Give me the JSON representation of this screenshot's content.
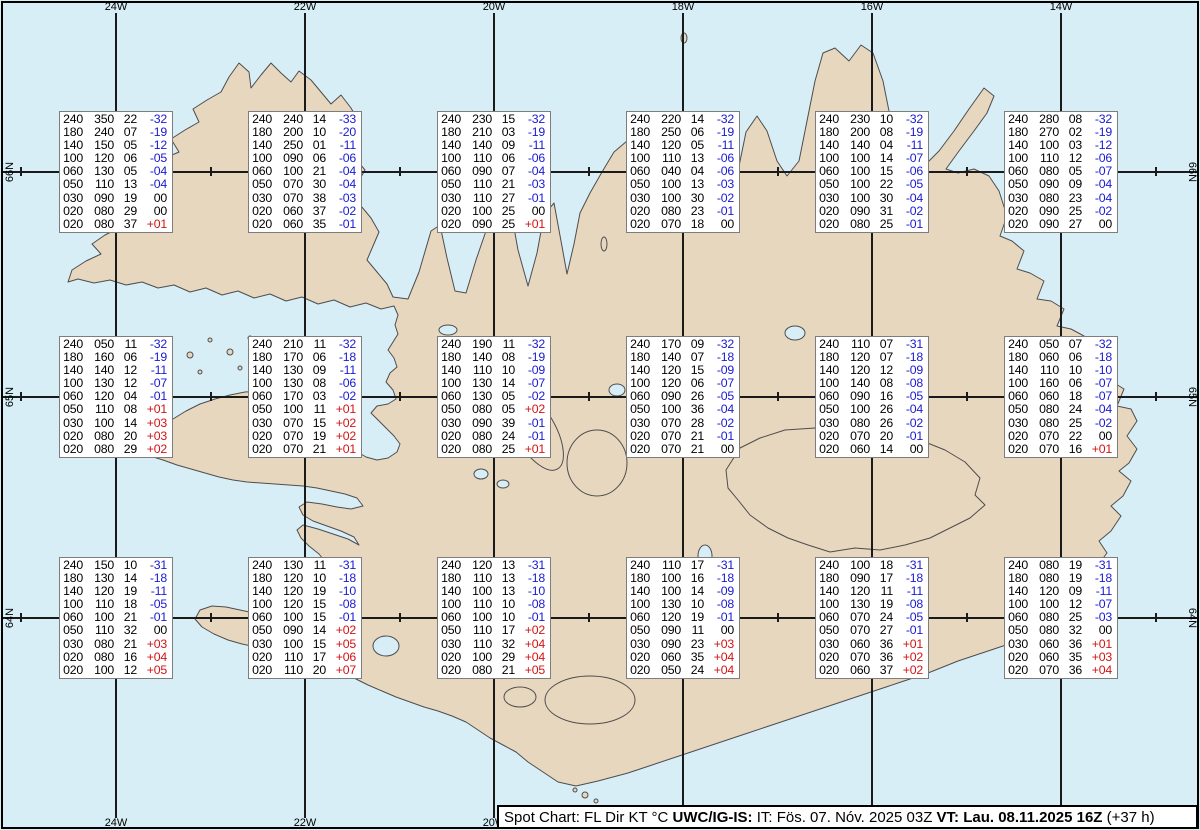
{
  "colors": {
    "ocean": "#d8eef7",
    "land": "#e8d7bf",
    "coast": "#4d4d4d",
    "grid": "#1a1a1a",
    "temp_negative": "#1a1ad2",
    "temp_positive": "#d21414",
    "temp_zero": "#000000",
    "box_border": "#7d7d7d"
  },
  "grid": {
    "meridians": [
      {
        "label": "24W",
        "x": 116
      },
      {
        "label": "22W",
        "x": 305
      },
      {
        "label": "20W",
        "x": 494
      },
      {
        "label": "18W",
        "x": 683
      },
      {
        "label": "16W",
        "x": 872
      },
      {
        "label": "14W",
        "x": 1061
      }
    ],
    "parallels": [
      {
        "label": "66N",
        "y": 172
      },
      {
        "label": "65N",
        "y": 397
      },
      {
        "label": "64N",
        "y": 618
      }
    ],
    "minor_tick_xs": [
      21,
      211,
      400,
      589,
      778,
      967,
      1156
    ]
  },
  "stations": [
    {
      "id": "66N-24W",
      "col": 0,
      "row": 0,
      "levels": [
        [
          "240",
          "350",
          "22",
          "-32"
        ],
        [
          "180",
          "240",
          "07",
          "-19"
        ],
        [
          "140",
          "150",
          "05",
          "-12"
        ],
        [
          "100",
          "120",
          "06",
          "-05"
        ],
        [
          "060",
          "130",
          "05",
          "-04"
        ],
        [
          "050",
          "110",
          "13",
          "-04"
        ],
        [
          "030",
          "090",
          "19",
          "00"
        ],
        [
          "020",
          "080",
          "29",
          "00"
        ],
        [
          "020",
          "080",
          "37",
          "+01"
        ]
      ]
    },
    {
      "id": "66N-22W",
      "col": 1,
      "row": 0,
      "levels": [
        [
          "240",
          "240",
          "14",
          "-33"
        ],
        [
          "180",
          "200",
          "10",
          "-20"
        ],
        [
          "140",
          "250",
          "01",
          "-11"
        ],
        [
          "100",
          "090",
          "06",
          "-06"
        ],
        [
          "060",
          "100",
          "21",
          "-04"
        ],
        [
          "050",
          "070",
          "30",
          "-04"
        ],
        [
          "030",
          "070",
          "38",
          "-03"
        ],
        [
          "020",
          "060",
          "37",
          "-02"
        ],
        [
          "020",
          "060",
          "35",
          "-01"
        ]
      ]
    },
    {
      "id": "66N-20W",
      "col": 2,
      "row": 0,
      "levels": [
        [
          "240",
          "230",
          "15",
          "-32"
        ],
        [
          "180",
          "210",
          "03",
          "-19"
        ],
        [
          "140",
          "140",
          "09",
          "-11"
        ],
        [
          "100",
          "110",
          "06",
          "-06"
        ],
        [
          "060",
          "090",
          "07",
          "-04"
        ],
        [
          "050",
          "110",
          "21",
          "-03"
        ],
        [
          "030",
          "110",
          "27",
          "-01"
        ],
        [
          "020",
          "100",
          "25",
          "00"
        ],
        [
          "020",
          "090",
          "25",
          "+01"
        ]
      ]
    },
    {
      "id": "66N-18W",
      "col": 3,
      "row": 0,
      "levels": [
        [
          "240",
          "220",
          "14",
          "-32"
        ],
        [
          "180",
          "250",
          "06",
          "-19"
        ],
        [
          "140",
          "120",
          "05",
          "-11"
        ],
        [
          "100",
          "110",
          "13",
          "-06"
        ],
        [
          "060",
          "040",
          "04",
          "-06"
        ],
        [
          "050",
          "100",
          "13",
          "-03"
        ],
        [
          "030",
          "100",
          "30",
          "-02"
        ],
        [
          "020",
          "080",
          "23",
          "-01"
        ],
        [
          "020",
          "070",
          "18",
          "00"
        ]
      ]
    },
    {
      "id": "66N-16W",
      "col": 4,
      "row": 0,
      "levels": [
        [
          "240",
          "230",
          "10",
          "-32"
        ],
        [
          "180",
          "200",
          "08",
          "-19"
        ],
        [
          "140",
          "140",
          "04",
          "-11"
        ],
        [
          "100",
          "100",
          "14",
          "-07"
        ],
        [
          "060",
          "100",
          "15",
          "-06"
        ],
        [
          "050",
          "100",
          "22",
          "-05"
        ],
        [
          "030",
          "100",
          "30",
          "-04"
        ],
        [
          "020",
          "090",
          "31",
          "-02"
        ],
        [
          "020",
          "080",
          "25",
          "-01"
        ]
      ]
    },
    {
      "id": "66N-14W",
      "col": 5,
      "row": 0,
      "levels": [
        [
          "240",
          "280",
          "08",
          "-32"
        ],
        [
          "180",
          "270",
          "02",
          "-19"
        ],
        [
          "140",
          "100",
          "03",
          "-12"
        ],
        [
          "100",
          "110",
          "12",
          "-06"
        ],
        [
          "060",
          "080",
          "05",
          "-07"
        ],
        [
          "050",
          "090",
          "09",
          "-04"
        ],
        [
          "030",
          "080",
          "23",
          "-04"
        ],
        [
          "020",
          "090",
          "25",
          "-02"
        ],
        [
          "020",
          "090",
          "27",
          "00"
        ]
      ]
    },
    {
      "id": "65N-24W",
      "col": 0,
      "row": 1,
      "levels": [
        [
          "240",
          "050",
          "11",
          "-32"
        ],
        [
          "180",
          "160",
          "06",
          "-19"
        ],
        [
          "140",
          "140",
          "12",
          "-11"
        ],
        [
          "100",
          "130",
          "12",
          "-07"
        ],
        [
          "060",
          "120",
          "04",
          "-01"
        ],
        [
          "050",
          "110",
          "08",
          "+01"
        ],
        [
          "030",
          "100",
          "14",
          "+03"
        ],
        [
          "020",
          "080",
          "20",
          "+03"
        ],
        [
          "020",
          "080",
          "29",
          "+02"
        ]
      ]
    },
    {
      "id": "65N-22W",
      "col": 1,
      "row": 1,
      "levels": [
        [
          "240",
          "210",
          "11",
          "-32"
        ],
        [
          "180",
          "170",
          "06",
          "-18"
        ],
        [
          "140",
          "130",
          "09",
          "-11"
        ],
        [
          "100",
          "130",
          "08",
          "-06"
        ],
        [
          "060",
          "170",
          "03",
          "-02"
        ],
        [
          "050",
          "100",
          "11",
          "+01"
        ],
        [
          "030",
          "070",
          "15",
          "+02"
        ],
        [
          "020",
          "070",
          "19",
          "+02"
        ],
        [
          "020",
          "070",
          "21",
          "+01"
        ]
      ]
    },
    {
      "id": "65N-20W",
      "col": 2,
      "row": 1,
      "levels": [
        [
          "240",
          "190",
          "11",
          "-32"
        ],
        [
          "180",
          "140",
          "08",
          "-19"
        ],
        [
          "140",
          "110",
          "10",
          "-09"
        ],
        [
          "100",
          "130",
          "14",
          "-07"
        ],
        [
          "060",
          "130",
          "05",
          "-02"
        ],
        [
          "050",
          "080",
          "05",
          "+02"
        ],
        [
          "030",
          "090",
          "39",
          "-01"
        ],
        [
          "020",
          "080",
          "24",
          "-01"
        ],
        [
          "020",
          "080",
          "25",
          "+01"
        ]
      ]
    },
    {
      "id": "65N-18W",
      "col": 3,
      "row": 1,
      "levels": [
        [
          "240",
          "170",
          "09",
          "-32"
        ],
        [
          "180",
          "140",
          "07",
          "-18"
        ],
        [
          "140",
          "120",
          "15",
          "-09"
        ],
        [
          "100",
          "120",
          "06",
          "-07"
        ],
        [
          "060",
          "090",
          "26",
          "-05"
        ],
        [
          "050",
          "100",
          "36",
          "-04"
        ],
        [
          "030",
          "070",
          "28",
          "-02"
        ],
        [
          "020",
          "070",
          "21",
          "-01"
        ],
        [
          "020",
          "070",
          "21",
          "00"
        ]
      ]
    },
    {
      "id": "65N-16W",
      "col": 4,
      "row": 1,
      "levels": [
        [
          "240",
          "110",
          "07",
          "-31"
        ],
        [
          "180",
          "120",
          "07",
          "-18"
        ],
        [
          "140",
          "120",
          "12",
          "-09"
        ],
        [
          "100",
          "140",
          "08",
          "-08"
        ],
        [
          "060",
          "090",
          "16",
          "-05"
        ],
        [
          "050",
          "100",
          "26",
          "-04"
        ],
        [
          "030",
          "080",
          "26",
          "-02"
        ],
        [
          "020",
          "070",
          "20",
          "-01"
        ],
        [
          "020",
          "060",
          "14",
          "00"
        ]
      ]
    },
    {
      "id": "65N-14W",
      "col": 5,
      "row": 1,
      "levels": [
        [
          "240",
          "050",
          "07",
          "-32"
        ],
        [
          "180",
          "060",
          "06",
          "-18"
        ],
        [
          "140",
          "110",
          "10",
          "-10"
        ],
        [
          "100",
          "160",
          "06",
          "-07"
        ],
        [
          "060",
          "060",
          "18",
          "-07"
        ],
        [
          "050",
          "080",
          "24",
          "-04"
        ],
        [
          "030",
          "080",
          "25",
          "-02"
        ],
        [
          "020",
          "070",
          "22",
          "00"
        ],
        [
          "020",
          "070",
          "16",
          "+01"
        ]
      ]
    },
    {
      "id": "64N-24W",
      "col": 0,
      "row": 2,
      "levels": [
        [
          "240",
          "150",
          "10",
          "-31"
        ],
        [
          "180",
          "130",
          "14",
          "-18"
        ],
        [
          "140",
          "120",
          "19",
          "-11"
        ],
        [
          "100",
          "110",
          "18",
          "-05"
        ],
        [
          "060",
          "100",
          "21",
          "-01"
        ],
        [
          "050",
          "110",
          "32",
          "00"
        ],
        [
          "030",
          "080",
          "21",
          "+03"
        ],
        [
          "020",
          "080",
          "16",
          "+04"
        ],
        [
          "020",
          "100",
          "12",
          "+05"
        ]
      ]
    },
    {
      "id": "64N-22W",
      "col": 1,
      "row": 2,
      "levels": [
        [
          "240",
          "130",
          "11",
          "-31"
        ],
        [
          "180",
          "120",
          "10",
          "-18"
        ],
        [
          "140",
          "120",
          "19",
          "-10"
        ],
        [
          "100",
          "120",
          "15",
          "-08"
        ],
        [
          "060",
          "100",
          "15",
          "-01"
        ],
        [
          "050",
          "090",
          "14",
          "+02"
        ],
        [
          "030",
          "100",
          "15",
          "+05"
        ],
        [
          "020",
          "110",
          "17",
          "+06"
        ],
        [
          "020",
          "110",
          "20",
          "+07"
        ]
      ]
    },
    {
      "id": "64N-20W",
      "col": 2,
      "row": 2,
      "levels": [
        [
          "240",
          "120",
          "13",
          "-31"
        ],
        [
          "180",
          "110",
          "13",
          "-18"
        ],
        [
          "140",
          "100",
          "13",
          "-10"
        ],
        [
          "100",
          "110",
          "10",
          "-08"
        ],
        [
          "060",
          "100",
          "10",
          "-01"
        ],
        [
          "050",
          "110",
          "17",
          "+02"
        ],
        [
          "030",
          "110",
          "32",
          "+04"
        ],
        [
          "020",
          "100",
          "29",
          "+04"
        ],
        [
          "020",
          "080",
          "21",
          "+05"
        ]
      ]
    },
    {
      "id": "64N-18W",
      "col": 3,
      "row": 2,
      "levels": [
        [
          "240",
          "110",
          "17",
          "-31"
        ],
        [
          "180",
          "100",
          "16",
          "-18"
        ],
        [
          "140",
          "100",
          "14",
          "-09"
        ],
        [
          "100",
          "130",
          "10",
          "-08"
        ],
        [
          "060",
          "120",
          "19",
          "-01"
        ],
        [
          "050",
          "090",
          "11",
          "00"
        ],
        [
          "030",
          "090",
          "23",
          "+03"
        ],
        [
          "020",
          "060",
          "35",
          "+04"
        ],
        [
          "020",
          "050",
          "24",
          "+04"
        ]
      ]
    },
    {
      "id": "64N-16W",
      "col": 4,
      "row": 2,
      "levels": [
        [
          "240",
          "100",
          "18",
          "-31"
        ],
        [
          "180",
          "090",
          "17",
          "-18"
        ],
        [
          "140",
          "120",
          "11",
          "-11"
        ],
        [
          "100",
          "130",
          "19",
          "-08"
        ],
        [
          "060",
          "070",
          "24",
          "-05"
        ],
        [
          "050",
          "070",
          "27",
          "-01"
        ],
        [
          "030",
          "060",
          "36",
          "+01"
        ],
        [
          "020",
          "070",
          "36",
          "+02"
        ],
        [
          "020",
          "060",
          "37",
          "+02"
        ]
      ]
    },
    {
      "id": "64N-14W",
      "col": 5,
      "row": 2,
      "levels": [
        [
          "240",
          "080",
          "19",
          "-31"
        ],
        [
          "180",
          "080",
          "19",
          "-18"
        ],
        [
          "140",
          "120",
          "09",
          "-11"
        ],
        [
          "100",
          "100",
          "12",
          "-07"
        ],
        [
          "060",
          "080",
          "25",
          "-03"
        ],
        [
          "050",
          "080",
          "32",
          "00"
        ],
        [
          "030",
          "060",
          "36",
          "+01"
        ],
        [
          "020",
          "060",
          "35",
          "+03"
        ],
        [
          "020",
          "070",
          "36",
          "+04"
        ]
      ]
    }
  ],
  "status_bar": {
    "segments": [
      {
        "text": "Spot Chart: FL Dir KT °C ",
        "bold": false
      },
      {
        "text": "UWC/IG-IS:",
        "bold": true
      },
      {
        "text": " IT: Fös. 07. Nóv. 2025 03Z ",
        "bold": false
      },
      {
        "text": "VT: Lau. 08.11.2025 16Z",
        "bold": true
      },
      {
        "text": " (+37 h)",
        "bold": false
      }
    ]
  }
}
